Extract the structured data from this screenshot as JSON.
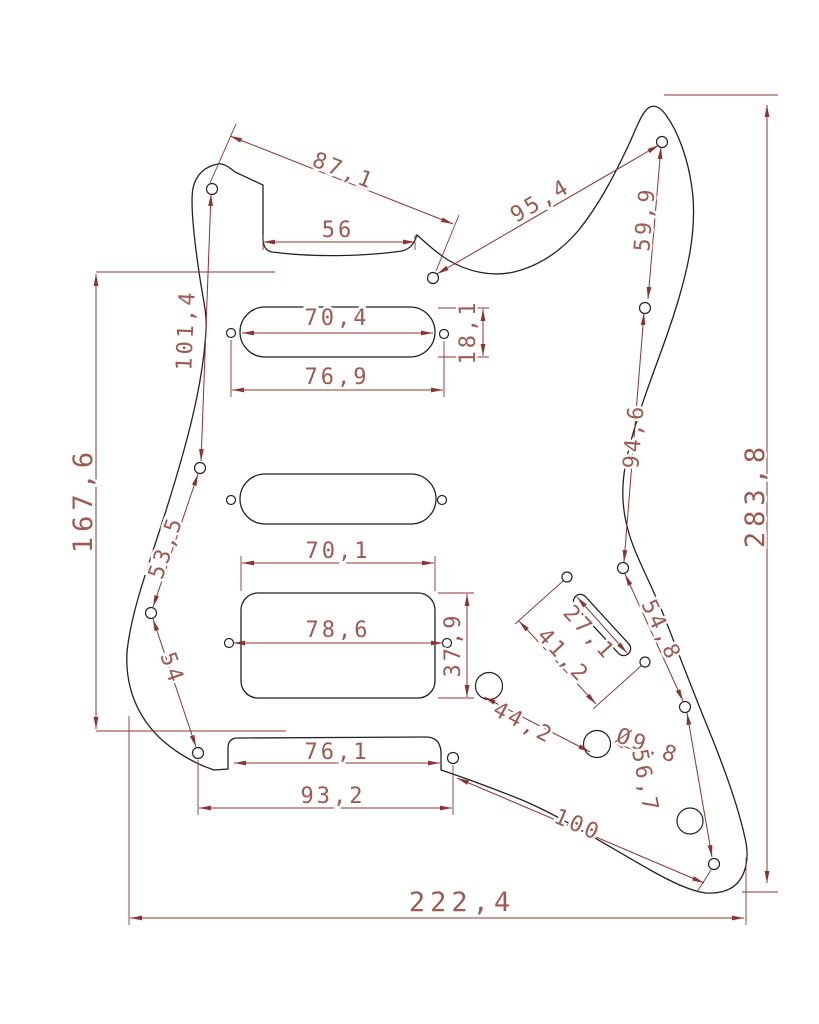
{
  "drawing_type": "pickguard-dimension-drawing",
  "colors": {
    "background": "#ffffff",
    "part_outline": "#222222",
    "dimension_line": "#8c3432",
    "dimension_text": "#9d5a50"
  },
  "dims": {
    "d87_1": "87,1",
    "d56": "56",
    "d95_4": "95,4",
    "d59_9": "59,9",
    "d101_4": "101,4",
    "d167_6": "167,6",
    "d53_5": "53,5",
    "d54": "54",
    "d70_4": "70,4",
    "d18_1": "18,1",
    "d76_9": "76,9",
    "d70_1": "70,1",
    "d78_6": "78,6",
    "d37_9": "37,9",
    "d94_6": "94,6",
    "d283_8": "283,8",
    "d54_8": "54,8",
    "d41_2": "41,2",
    "d27_1": "27,1",
    "d44_2": "44,2",
    "dia9_8": "Ø9,8",
    "d100": "100",
    "d56_7": "56,7",
    "d76_1": "76,1",
    "d93_2": "93,2",
    "d222_4": "222,4"
  }
}
